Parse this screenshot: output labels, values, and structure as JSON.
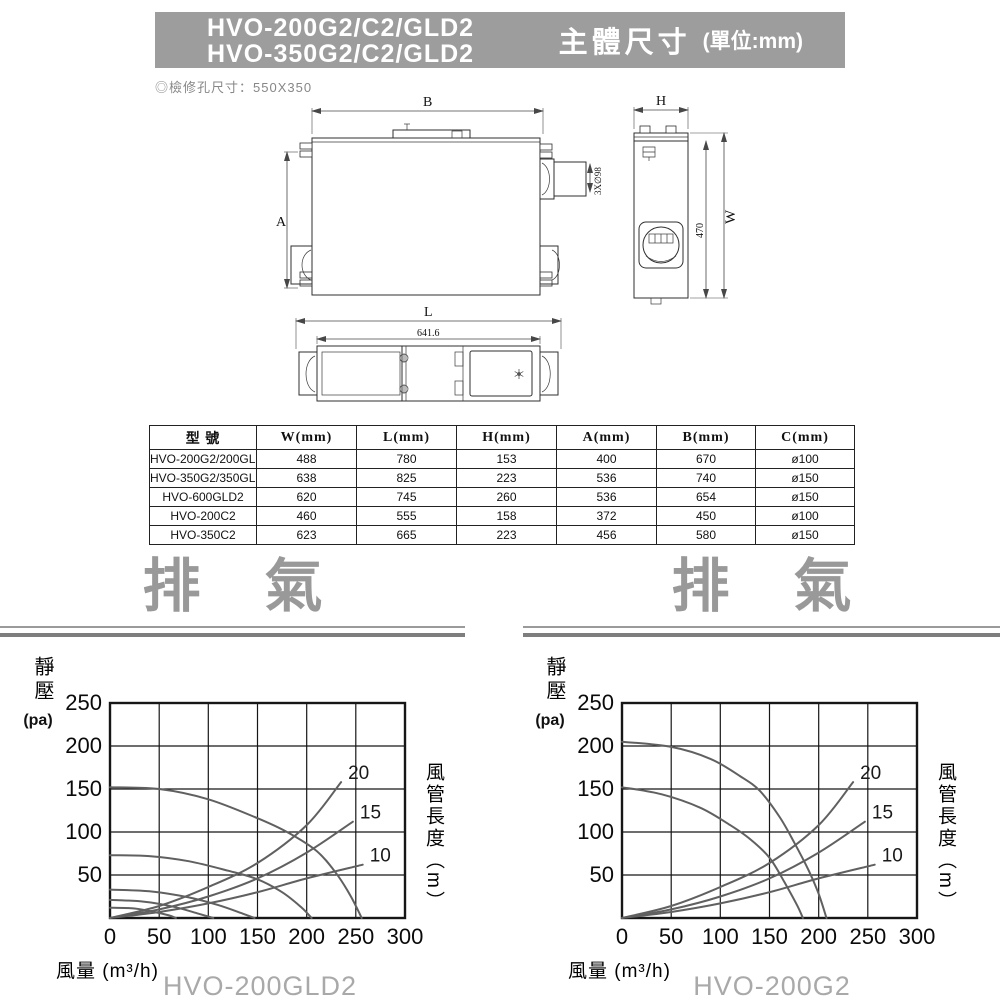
{
  "header": {
    "models": [
      "HVO-200G2/C2/GLD2",
      "HVO-350G2/C2/GLD2"
    ],
    "section_title": "主體尺寸",
    "unit_note": "(單位:mm)",
    "bar_color": "#9d9d9d"
  },
  "inspection_note": "◎檢修孔尺寸：550X350",
  "drawings": {
    "top_view": {
      "dim_width": "B",
      "dim_height": "A",
      "duct_label": "3X∅98"
    },
    "side_view": {
      "dim_width": "H",
      "dim_height": "W",
      "inner_height": "470"
    },
    "bottom_view": {
      "dim_width": "L",
      "inner_width": "641.6"
    }
  },
  "table": {
    "headers": [
      "型 號",
      "W(mm)",
      "L(mm)",
      "H(mm)",
      "A(mm)",
      "B(mm)",
      "C(mm)"
    ],
    "rows": [
      [
        "HVO-200G2/200GLD2",
        "488",
        "780",
        "153",
        "400",
        "670",
        "ø100"
      ],
      [
        "HVO-350G2/350GLD2",
        "638",
        "825",
        "223",
        "536",
        "740",
        "ø150"
      ],
      [
        "HVO-600GLD2",
        "620",
        "745",
        "260",
        "536",
        "654",
        "ø150"
      ],
      [
        "HVO-200C2",
        "460",
        "555",
        "158",
        "372",
        "450",
        "ø100"
      ],
      [
        "HVO-350C2",
        "623",
        "665",
        "223",
        "456",
        "580",
        "ø150"
      ]
    ]
  },
  "exhaust_sections": [
    {
      "label": "排氣"
    },
    {
      "label": "排氣"
    }
  ],
  "chart_data": [
    {
      "type": "line",
      "title": "HVO-200GLD2",
      "ylabel_main": "靜壓",
      "ylabel_unit": "(pa)",
      "xlabel": "風量 (m³/h)",
      "y2label": "風管長度（m）",
      "xlim": [
        0,
        300
      ],
      "ylim": [
        0,
        250
      ],
      "xticks": [
        0,
        50,
        100,
        150,
        200,
        250,
        300
      ],
      "yticks": [
        250,
        200,
        150,
        100,
        50
      ],
      "grid": true,
      "series": [
        {
          "name": "fan-speed-1",
          "points": [
            [
              0,
              152
            ],
            [
              50,
              150
            ],
            [
              100,
              138
            ],
            [
              150,
              116
            ],
            [
              180,
              100
            ],
            [
              210,
              78
            ],
            [
              230,
              52
            ],
            [
              245,
              25
            ],
            [
              256,
              0
            ]
          ]
        },
        {
          "name": "fan-speed-2",
          "points": [
            [
              0,
              73
            ],
            [
              40,
              72
            ],
            [
              80,
              66
            ],
            [
              120,
              55
            ],
            [
              150,
              45
            ],
            [
              175,
              30
            ],
            [
              195,
              12
            ],
            [
              205,
              0
            ]
          ]
        },
        {
          "name": "fan-speed-3",
          "points": [
            [
              0,
              33
            ],
            [
              40,
              31
            ],
            [
              80,
              24
            ],
            [
              110,
              15
            ],
            [
              135,
              5
            ],
            [
              147,
              0
            ]
          ]
        },
        {
          "name": "fan-speed-4",
          "points": [
            [
              0,
              21
            ],
            [
              35,
              19
            ],
            [
              65,
              13
            ],
            [
              90,
              5
            ],
            [
              105,
              0
            ]
          ]
        },
        {
          "name": "fan-speed-5",
          "points": [
            [
              0,
              12
            ],
            [
              25,
              11
            ],
            [
              45,
              7
            ],
            [
              60,
              3
            ],
            [
              67,
              0
            ]
          ]
        },
        {
          "name": "duct-length-20",
          "label": "20",
          "points": [
            [
              0,
              0
            ],
            [
              50,
              14
            ],
            [
              100,
              36
            ],
            [
              150,
              64
            ],
            [
              200,
              108
            ],
            [
              235,
              158
            ]
          ]
        },
        {
          "name": "duct-length-15",
          "label": "15",
          "points": [
            [
              0,
              0
            ],
            [
              50,
              10
            ],
            [
              100,
              25
            ],
            [
              150,
              46
            ],
            [
              200,
              76
            ],
            [
              247,
              112
            ]
          ]
        },
        {
          "name": "duct-length-10",
          "label": "10",
          "points": [
            [
              0,
              0
            ],
            [
              50,
              7
            ],
            [
              100,
              17
            ],
            [
              150,
              30
            ],
            [
              200,
              46
            ],
            [
              257,
              62
            ]
          ]
        }
      ]
    },
    {
      "type": "line",
      "title": "HVO-200G2",
      "ylabel_main": "靜壓",
      "ylabel_unit": "(pa)",
      "xlabel": "風量 (m³/h)",
      "y2label": "風管長度（m）",
      "xlim": [
        0,
        300
      ],
      "ylim": [
        0,
        250
      ],
      "xticks": [
        0,
        50,
        100,
        150,
        200,
        250,
        300
      ],
      "yticks": [
        250,
        200,
        150,
        100,
        50
      ],
      "grid": true,
      "series": [
        {
          "name": "fan-speed-high",
          "points": [
            [
              0,
              205
            ],
            [
              50,
              199
            ],
            [
              90,
              185
            ],
            [
              120,
              165
            ],
            [
              140,
              148
            ],
            [
              160,
              118
            ],
            [
              175,
              88
            ],
            [
              190,
              55
            ],
            [
              200,
              28
            ],
            [
              208,
              0
            ]
          ]
        },
        {
          "name": "fan-speed-low",
          "points": [
            [
              0,
              152
            ],
            [
              40,
              144
            ],
            [
              80,
              128
            ],
            [
              110,
              108
            ],
            [
              130,
              92
            ],
            [
              150,
              70
            ],
            [
              165,
              42
            ],
            [
              178,
              15
            ],
            [
              184,
              0
            ]
          ]
        },
        {
          "name": "duct-length-20",
          "label": "20",
          "points": [
            [
              0,
              0
            ],
            [
              50,
              14
            ],
            [
              100,
              36
            ],
            [
              150,
              64
            ],
            [
              200,
              108
            ],
            [
              235,
              158
            ]
          ]
        },
        {
          "name": "duct-length-15",
          "label": "15",
          "points": [
            [
              0,
              0
            ],
            [
              50,
              10
            ],
            [
              100,
              25
            ],
            [
              150,
              46
            ],
            [
              200,
              76
            ],
            [
              247,
              112
            ]
          ]
        },
        {
          "name": "duct-length-10",
          "label": "10",
          "points": [
            [
              0,
              0
            ],
            [
              50,
              7
            ],
            [
              100,
              17
            ],
            [
              150,
              30
            ],
            [
              200,
              46
            ],
            [
              257,
              62
            ]
          ]
        }
      ]
    }
  ]
}
